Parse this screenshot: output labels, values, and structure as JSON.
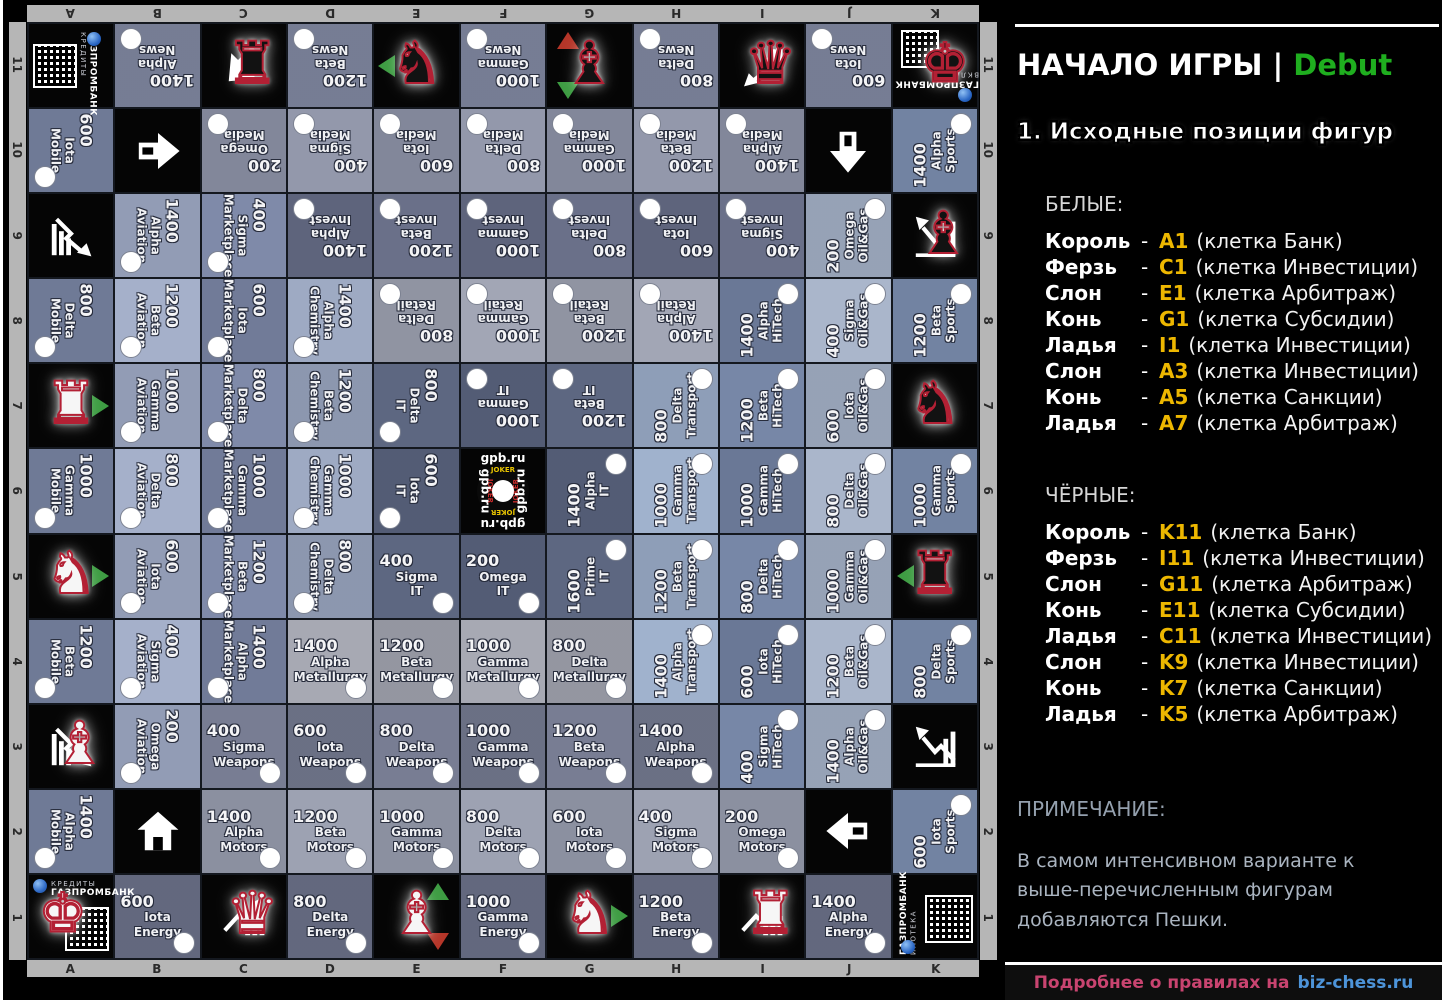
{
  "colors": {
    "accent_green": "#1fae1f",
    "position_yellow": "#edb700",
    "footer_pink": "#c94470",
    "footer_blue": "#4d94d9",
    "piece_outline_red": "#b32034",
    "triangle_green": "#3d9c42",
    "triangle_red": "#b53528",
    "frame_gray": "#b6b6b6"
  },
  "board": {
    "files": [
      "A",
      "B",
      "C",
      "D",
      "E",
      "F",
      "G",
      "H",
      "I",
      "J",
      "K"
    ],
    "ranks_top_to_bottom": [
      "11",
      "10",
      "9",
      "8",
      "7",
      "6",
      "5",
      "4",
      "3",
      "2",
      "1"
    ],
    "industry_colors": {
      "news": "#858ca4",
      "media": "#9398ab",
      "invest": "#6a7089",
      "retail": "#a2a6b5",
      "it": "#5d6781",
      "metallurgy": "#a7a9b3",
      "weapons": "#787d93",
      "motors": "#9da2b2",
      "energy": "#6f758b",
      "mobile": "#7d89a7",
      "aviation": "#a5b0ca",
      "marketplace": "#7f8aa9",
      "chemistry": "#9eaac3",
      "transport": "#a0b2cd",
      "hitech": "#7787a7",
      "oilgas": "#aab6cb",
      "sports": "#8093b4"
    },
    "brand": {
      "bank": "ГАЗПРОМБАНК",
      "center_site": "gpb.ru",
      "center_ring": "JOKER"
    },
    "cells": [
      {
        "id": "A11",
        "t": "c",
        "variant": "a11",
        "sub": "КРЕДИТЫ"
      },
      {
        "id": "B11",
        "t": "p",
        "v": "1400",
        "n": "Alpha News",
        "rot": 180
      },
      {
        "id": "C11",
        "t": "s",
        "pg": "rook",
        "pc": "b",
        "icon": "arrow",
        "irot": 135
      },
      {
        "id": "D11",
        "t": "p",
        "v": "1200",
        "n": "Beta News",
        "rot": 180
      },
      {
        "id": "E11",
        "t": "s",
        "pg": "knight",
        "pc": "b",
        "tri": [
          "l-g"
        ]
      },
      {
        "id": "F11",
        "t": "p",
        "v": "1000",
        "n": "Gamma News",
        "rot": 180
      },
      {
        "id": "G11",
        "t": "s",
        "pg": "bishop",
        "pc": "b",
        "tri": [
          "u-r",
          "d-g"
        ]
      },
      {
        "id": "H11",
        "t": "p",
        "v": "800",
        "n": "Delta News",
        "rot": 180
      },
      {
        "id": "I11",
        "t": "s",
        "pg": "queen",
        "pc": "b",
        "icon": "chart-dl"
      },
      {
        "id": "J11",
        "t": "p",
        "v": "600",
        "n": "Iota News",
        "rot": 180
      },
      {
        "id": "K11",
        "t": "c",
        "variant": "k11",
        "sub": "ВКЛАДЫ",
        "pg": "king",
        "pc": "b"
      },
      {
        "id": "A10",
        "t": "p",
        "v": "600",
        "n": "Iota Mobile",
        "rot": 90
      },
      {
        "id": "B10",
        "t": "s",
        "icon": "arrow",
        "irot": 0
      },
      {
        "id": "C10",
        "t": "p",
        "v": "200",
        "n": "Omega Media",
        "rot": 180
      },
      {
        "id": "D10",
        "t": "p",
        "v": "400",
        "n": "Sigma Media",
        "rot": 180
      },
      {
        "id": "E10",
        "t": "p",
        "v": "600",
        "n": "Iota Media",
        "rot": 180
      },
      {
        "id": "F10",
        "t": "p",
        "v": "800",
        "n": "Delta Media",
        "rot": 180
      },
      {
        "id": "G10",
        "t": "p",
        "v": "1000",
        "n": "Gamma Media",
        "rot": 180
      },
      {
        "id": "H10",
        "t": "p",
        "v": "1200",
        "n": "Beta Media",
        "rot": 180
      },
      {
        "id": "I10",
        "t": "p",
        "v": "1400",
        "n": "Alpha Media",
        "rot": 180
      },
      {
        "id": "J10",
        "t": "s",
        "icon": "arrow",
        "irot": 90
      },
      {
        "id": "K10",
        "t": "p",
        "v": "1400",
        "n": "Alpha Sports",
        "rot": 270
      },
      {
        "id": "A9",
        "t": "s",
        "icon": "chart-dr"
      },
      {
        "id": "B9",
        "t": "p",
        "v": "1400",
        "n": "Alpha Aviation",
        "rot": 90
      },
      {
        "id": "C9",
        "t": "p",
        "v": "400",
        "n": "Sigma Marketplace",
        "rot": 90
      },
      {
        "id": "D9",
        "t": "p",
        "v": "1400",
        "n": "Alpha Invest",
        "rot": 180
      },
      {
        "id": "E9",
        "t": "p",
        "v": "1200",
        "n": "Beta Invest",
        "rot": 180
      },
      {
        "id": "F9",
        "t": "p",
        "v": "1000",
        "n": "Gamma Invest",
        "rot": 180
      },
      {
        "id": "G9",
        "t": "p",
        "v": "800",
        "n": "Delta Invest",
        "rot": 180
      },
      {
        "id": "H9",
        "t": "p",
        "v": "600",
        "n": "Iota Invest",
        "rot": 180
      },
      {
        "id": "I9",
        "t": "p",
        "v": "400",
        "n": "Sigma Invest",
        "rot": 180
      },
      {
        "id": "J9",
        "t": "p",
        "v": "200",
        "n": "Omega Oil&Gas",
        "rot": 270
      },
      {
        "id": "K9",
        "t": "s",
        "pg": "bishop",
        "pc": "b",
        "icon": "chart-ul"
      },
      {
        "id": "A8",
        "t": "p",
        "v": "800",
        "n": "Delta Mobile",
        "rot": 90
      },
      {
        "id": "B8",
        "t": "p",
        "v": "1200",
        "n": "Beta Aviation",
        "rot": 90
      },
      {
        "id": "C8",
        "t": "p",
        "v": "600",
        "n": "Iota Marketplace",
        "rot": 90
      },
      {
        "id": "D8",
        "t": "p",
        "v": "1400",
        "n": "Alpha Chemistry",
        "rot": 90
      },
      {
        "id": "E8",
        "t": "p",
        "v": "800",
        "n": "Delta Retail",
        "rot": 180
      },
      {
        "id": "F8",
        "t": "p",
        "v": "1000",
        "n": "Gamma Retail",
        "rot": 180
      },
      {
        "id": "G8",
        "t": "p",
        "v": "1200",
        "n": "Beta Retail",
        "rot": 180
      },
      {
        "id": "H8",
        "t": "p",
        "v": "1400",
        "n": "Alpha Retail",
        "rot": 180
      },
      {
        "id": "I8",
        "t": "p",
        "v": "1400",
        "n": "Alpha HiTech",
        "rot": 270
      },
      {
        "id": "J8",
        "t": "p",
        "v": "400",
        "n": "Sigma Oil&Gas",
        "rot": 270
      },
      {
        "id": "K8",
        "t": "p",
        "v": "1200",
        "n": "Beta Sports",
        "rot": 270
      },
      {
        "id": "A7",
        "t": "s",
        "pg": "rook",
        "pc": "w",
        "tri": [
          "r-g"
        ]
      },
      {
        "id": "B7",
        "t": "p",
        "v": "1000",
        "n": "Gamma Aviation",
        "rot": 90
      },
      {
        "id": "C7",
        "t": "p",
        "v": "800",
        "n": "Delta Marketplace",
        "rot": 90
      },
      {
        "id": "D7",
        "t": "p",
        "v": "1200",
        "n": "Beta Chemistry",
        "rot": 90
      },
      {
        "id": "E7",
        "t": "p",
        "v": "800",
        "n": "Delta IT",
        "rot": 90
      },
      {
        "id": "F7",
        "t": "p",
        "v": "1000",
        "n": "Gamma IT",
        "rot": 180
      },
      {
        "id": "G7",
        "t": "p",
        "v": "1200",
        "n": "Beta IT",
        "rot": 180
      },
      {
        "id": "H7",
        "t": "p",
        "v": "800",
        "n": "Delta Transport",
        "rot": 270
      },
      {
        "id": "I7",
        "t": "p",
        "v": "1200",
        "n": "Beta HiTech",
        "rot": 270
      },
      {
        "id": "J7",
        "t": "p",
        "v": "600",
        "n": "Iota Oil&Gas",
        "rot": 270
      },
      {
        "id": "K7",
        "t": "s",
        "pg": "knight",
        "pc": "b"
      },
      {
        "id": "A6",
        "t": "p",
        "v": "1000",
        "n": "Gamma Mobile",
        "rot": 90
      },
      {
        "id": "B6",
        "t": "p",
        "v": "800",
        "n": "Delta Aviation",
        "rot": 90
      },
      {
        "id": "C6",
        "t": "p",
        "v": "1000",
        "n": "Gamma Marketplace",
        "rot": 90
      },
      {
        "id": "D6",
        "t": "p",
        "v": "1000",
        "n": "Gamma Chemistry",
        "rot": 90
      },
      {
        "id": "E6",
        "t": "p",
        "v": "600",
        "n": "Iota IT",
        "rot": 90
      },
      {
        "id": "F6",
        "t": "g"
      },
      {
        "id": "G6",
        "t": "p",
        "v": "1400",
        "n": "Alpha IT",
        "rot": 270
      },
      {
        "id": "H6",
        "t": "p",
        "v": "1000",
        "n": "Gamma Transport",
        "rot": 270
      },
      {
        "id": "I6",
        "t": "p",
        "v": "1000",
        "n": "Gamma HiTech",
        "rot": 270
      },
      {
        "id": "J6",
        "t": "p",
        "v": "800",
        "n": "Delta Oil&Gas",
        "rot": 270
      },
      {
        "id": "K6",
        "t": "p",
        "v": "1000",
        "n": "Gamma Sports",
        "rot": 270
      },
      {
        "id": "A5",
        "t": "s",
        "pg": "knight",
        "pc": "w",
        "tri": [
          "r-g"
        ]
      },
      {
        "id": "B5",
        "t": "p",
        "v": "600",
        "n": "Iota Aviation",
        "rot": 90
      },
      {
        "id": "C5",
        "t": "p",
        "v": "1200",
        "n": "Beta Marketplace",
        "rot": 90
      },
      {
        "id": "D5",
        "t": "p",
        "v": "800",
        "n": "Delta Chemistry",
        "rot": 90
      },
      {
        "id": "E5",
        "t": "p",
        "v": "400",
        "n": "Sigma IT",
        "rot": 0
      },
      {
        "id": "F5",
        "t": "p",
        "v": "200",
        "n": "Omega IT",
        "rot": 0
      },
      {
        "id": "G5",
        "t": "p",
        "v": "1600",
        "n": "Prime IT",
        "rot": 270
      },
      {
        "id": "H5",
        "t": "p",
        "v": "1200",
        "n": "Beta Transport",
        "rot": 270
      },
      {
        "id": "I5",
        "t": "p",
        "v": "800",
        "n": "Delta HiTech",
        "rot": 270
      },
      {
        "id": "J5",
        "t": "p",
        "v": "1000",
        "n": "Gamma Oil&Gas",
        "rot": 270
      },
      {
        "id": "K5",
        "t": "s",
        "pg": "rook",
        "pc": "b",
        "tri": [
          "l-g"
        ]
      },
      {
        "id": "A4",
        "t": "p",
        "v": "1200",
        "n": "Beta Mobile",
        "rot": 90
      },
      {
        "id": "B4",
        "t": "p",
        "v": "400",
        "n": "Sigma Aviation",
        "rot": 90
      },
      {
        "id": "C4",
        "t": "p",
        "v": "1400",
        "n": "Alpha Marketplace",
        "rot": 90
      },
      {
        "id": "D4",
        "t": "p",
        "v": "1400",
        "n": "Alpha Metallurgy",
        "rot": 0
      },
      {
        "id": "E4",
        "t": "p",
        "v": "1200",
        "n": "Beta Metallurgy",
        "rot": 0
      },
      {
        "id": "F4",
        "t": "p",
        "v": "1000",
        "n": "Gamma Metallurgy",
        "rot": 0
      },
      {
        "id": "G4",
        "t": "p",
        "v": "800",
        "n": "Delta Metallurgy",
        "rot": 0
      },
      {
        "id": "H4",
        "t": "p",
        "v": "1400",
        "n": "Alpha Transport",
        "rot": 270
      },
      {
        "id": "I4",
        "t": "p",
        "v": "600",
        "n": "Iota HiTech",
        "rot": 270
      },
      {
        "id": "J4",
        "t": "p",
        "v": "1200",
        "n": "Beta Oil&Gas",
        "rot": 270
      },
      {
        "id": "K4",
        "t": "p",
        "v": "800",
        "n": "Delta Sports",
        "rot": 270
      },
      {
        "id": "A3",
        "t": "s",
        "pg": "bishop",
        "pc": "w",
        "icon": "chart-dr"
      },
      {
        "id": "B3",
        "t": "p",
        "v": "200",
        "n": "Omega Aviation",
        "rot": 90
      },
      {
        "id": "C3",
        "t": "p",
        "v": "400",
        "n": "Sigma Weapons",
        "rot": 0
      },
      {
        "id": "D3",
        "t": "p",
        "v": "600",
        "n": "Iota Weapons",
        "rot": 0
      },
      {
        "id": "E3",
        "t": "p",
        "v": "800",
        "n": "Delta Weapons",
        "rot": 0
      },
      {
        "id": "F3",
        "t": "p",
        "v": "1000",
        "n": "Gamma Weapons",
        "rot": 0
      },
      {
        "id": "G3",
        "t": "p",
        "v": "1200",
        "n": "Beta Weapons",
        "rot": 0
      },
      {
        "id": "H3",
        "t": "p",
        "v": "1400",
        "n": "Alpha Weapons",
        "rot": 0
      },
      {
        "id": "I3",
        "t": "p",
        "v": "400",
        "n": "Sigma HiTech",
        "rot": 270
      },
      {
        "id": "J3",
        "t": "p",
        "v": "1400",
        "n": "Alpha Oil&Gas",
        "rot": 270
      },
      {
        "id": "K3",
        "t": "s",
        "icon": "chart-ul"
      },
      {
        "id": "A2",
        "t": "p",
        "v": "1400",
        "n": "Alpha Mobile",
        "rot": 90
      },
      {
        "id": "B2",
        "t": "s",
        "icon": "house"
      },
      {
        "id": "C2",
        "t": "p",
        "v": "1400",
        "n": "Alpha Motors",
        "rot": 0
      },
      {
        "id": "D2",
        "t": "p",
        "v": "1200",
        "n": "Beta Motors",
        "rot": 0
      },
      {
        "id": "E2",
        "t": "p",
        "v": "1000",
        "n": "Gamma Motors",
        "rot": 0
      },
      {
        "id": "F2",
        "t": "p",
        "v": "800",
        "n": "Delta Motors",
        "rot": 0
      },
      {
        "id": "G2",
        "t": "p",
        "v": "600",
        "n": "Iota Motors",
        "rot": 0
      },
      {
        "id": "H2",
        "t": "p",
        "v": "400",
        "n": "Sigma Motors",
        "rot": 0
      },
      {
        "id": "I2",
        "t": "p",
        "v": "200",
        "n": "Omega Motors",
        "rot": 0
      },
      {
        "id": "J2",
        "t": "s",
        "icon": "arrow",
        "irot": 180
      },
      {
        "id": "K2",
        "t": "p",
        "v": "600",
        "n": "Iota Sports",
        "rot": 270
      },
      {
        "id": "A1",
        "t": "c",
        "variant": "a1",
        "sub": "КРЕДИТЫ",
        "pg": "king",
        "pc": "w"
      },
      {
        "id": "B1",
        "t": "p",
        "v": "600",
        "n": "Iota Energy",
        "rot": 0
      },
      {
        "id": "C1",
        "t": "s",
        "pg": "queen",
        "pc": "w",
        "icon": "chart-ur"
      },
      {
        "id": "D1",
        "t": "p",
        "v": "800",
        "n": "Delta Energy",
        "rot": 0
      },
      {
        "id": "E1",
        "t": "s",
        "pg": "bishop",
        "pc": "w",
        "tri": [
          "u-g",
          "d-r"
        ]
      },
      {
        "id": "F1",
        "t": "p",
        "v": "1000",
        "n": "Gamma Energy",
        "rot": 0
      },
      {
        "id": "G1",
        "t": "s",
        "pg": "knight",
        "pc": "w",
        "tri": [
          "r-g"
        ]
      },
      {
        "id": "H1",
        "t": "p",
        "v": "1200",
        "n": "Beta Energy",
        "rot": 0
      },
      {
        "id": "I1",
        "t": "s",
        "pg": "rook",
        "pc": "w",
        "icon": "chart-ur"
      },
      {
        "id": "J1",
        "t": "p",
        "v": "1400",
        "n": "Alpha Energy",
        "rot": 0
      },
      {
        "id": "K1",
        "t": "c",
        "variant": "k1",
        "sub": "ИПОТЕКА"
      }
    ]
  },
  "panel": {
    "title": "НАЧАЛО ИГРЫ |",
    "title_accent": "Debut",
    "heading": "1. Исходные позиции фигур",
    "white_label": "БЕЛЫЕ:",
    "black_label": "ЧЁРНЫЕ:",
    "dash": "-",
    "white_pieces": [
      {
        "piece": "Король",
        "pos": "A1",
        "cell": "(клетка Банк)"
      },
      {
        "piece": "Ферзь",
        "pos": "C1",
        "cell": "(клетка Инвестиции)"
      },
      {
        "piece": "Слон",
        "pos": "E1",
        "cell": "(клетка Арбитраж)"
      },
      {
        "piece": "Конь",
        "pos": "G1",
        "cell": "(клетка Субсидии)"
      },
      {
        "piece": "Ладья",
        "pos": "I1",
        "cell": "(клетка Инвестиции)"
      },
      {
        "piece": "Слон",
        "pos": "A3",
        "cell": "(клетка Инвестиции)"
      },
      {
        "piece": "Конь",
        "pos": "A5",
        "cell": "(клетка Санкции)"
      },
      {
        "piece": "Ладья",
        "pos": "A7",
        "cell": "(клетка Арбитраж)"
      }
    ],
    "black_pieces": [
      {
        "piece": "Король",
        "pos": "K11",
        "cell": "(клетка Банк)"
      },
      {
        "piece": "Ферзь",
        "pos": "I11",
        "cell": "(клетка Инвестиции)"
      },
      {
        "piece": "Слон",
        "pos": "G11",
        "cell": "(клетка Арбитраж)"
      },
      {
        "piece": "Конь",
        "pos": "E11",
        "cell": "(клетка Субсидии)"
      },
      {
        "piece": "Ладья",
        "pos": "C11",
        "cell": "(клетка Инвестиции)"
      },
      {
        "piece": "Слон",
        "pos": "K9",
        "cell": "(клетка Инвестиции)"
      },
      {
        "piece": "Конь",
        "pos": "K7",
        "cell": "(клетка Санкции)"
      },
      {
        "piece": "Ладья",
        "pos": "K5",
        "cell": "(клетка Арбитраж)"
      }
    ],
    "note_label": "ПРИМЕЧАНИЕ:",
    "note_text": "В самом интенсивном варианте к выше-перечисленным фигурам добавляются Пешки.",
    "footer_text": "Подробнее о правилах на",
    "footer_link": "biz-chess.ru"
  }
}
